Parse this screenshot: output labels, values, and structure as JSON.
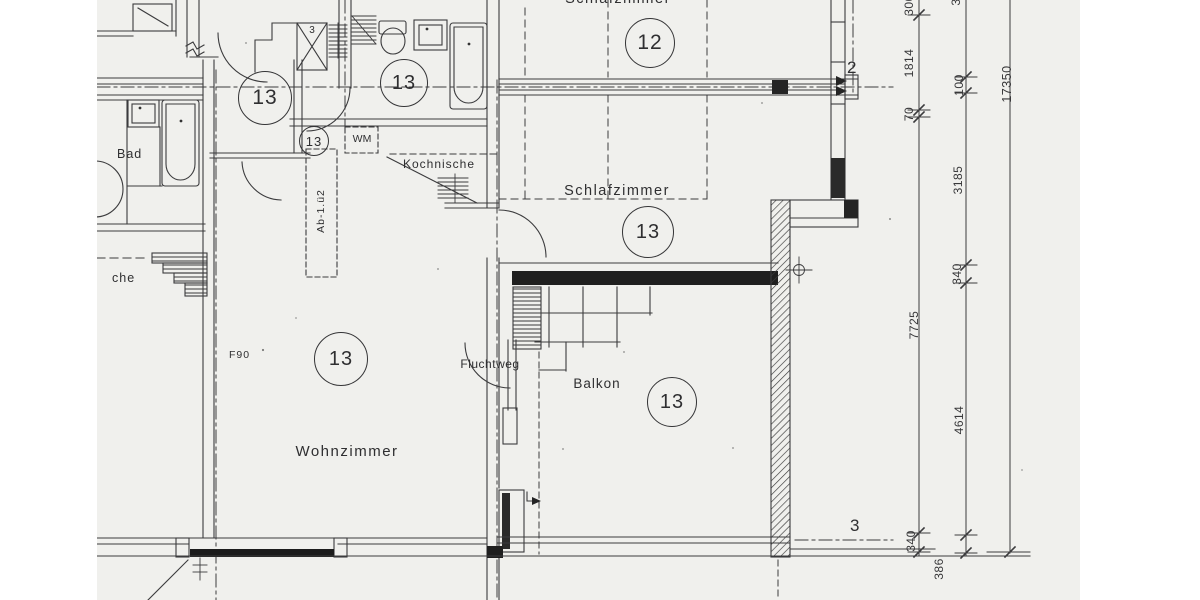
{
  "document": {
    "kind": "Architectural floor plan (scanned blueprint, German)",
    "rooms": {
      "schlafzimmer_top": "Schlafzimmer",
      "schlafzimmer": "Schlafzimmer",
      "wohnzimmer": "Wohnzimmer",
      "balkon": "Balkon",
      "kochnische": "Kochnische",
      "bad": "Bad",
      "kueche_partial": "che",
      "fluchtweg": "Fluchtweg"
    },
    "annotations": {
      "wm": "WM",
      "f90": "F90",
      "shaft_number": "3",
      "duct_label": "Ab-1.ü2"
    },
    "unit_circles": {
      "c12": "12",
      "c13": "13"
    },
    "axes": {
      "axis_2": "2",
      "axis_3": "3"
    },
    "dimensions_mm": {
      "inner_chain": {
        "top_partial": "300",
        "d1814": "1814",
        "d70": "70",
        "d7725": "7725",
        "d340": "340"
      },
      "outer_chain": {
        "top_partial": "3",
        "d100": "100",
        "d3185": "3185",
        "d340": "340",
        "d4614": "4614",
        "d386": "386"
      },
      "overall": "17350"
    }
  }
}
